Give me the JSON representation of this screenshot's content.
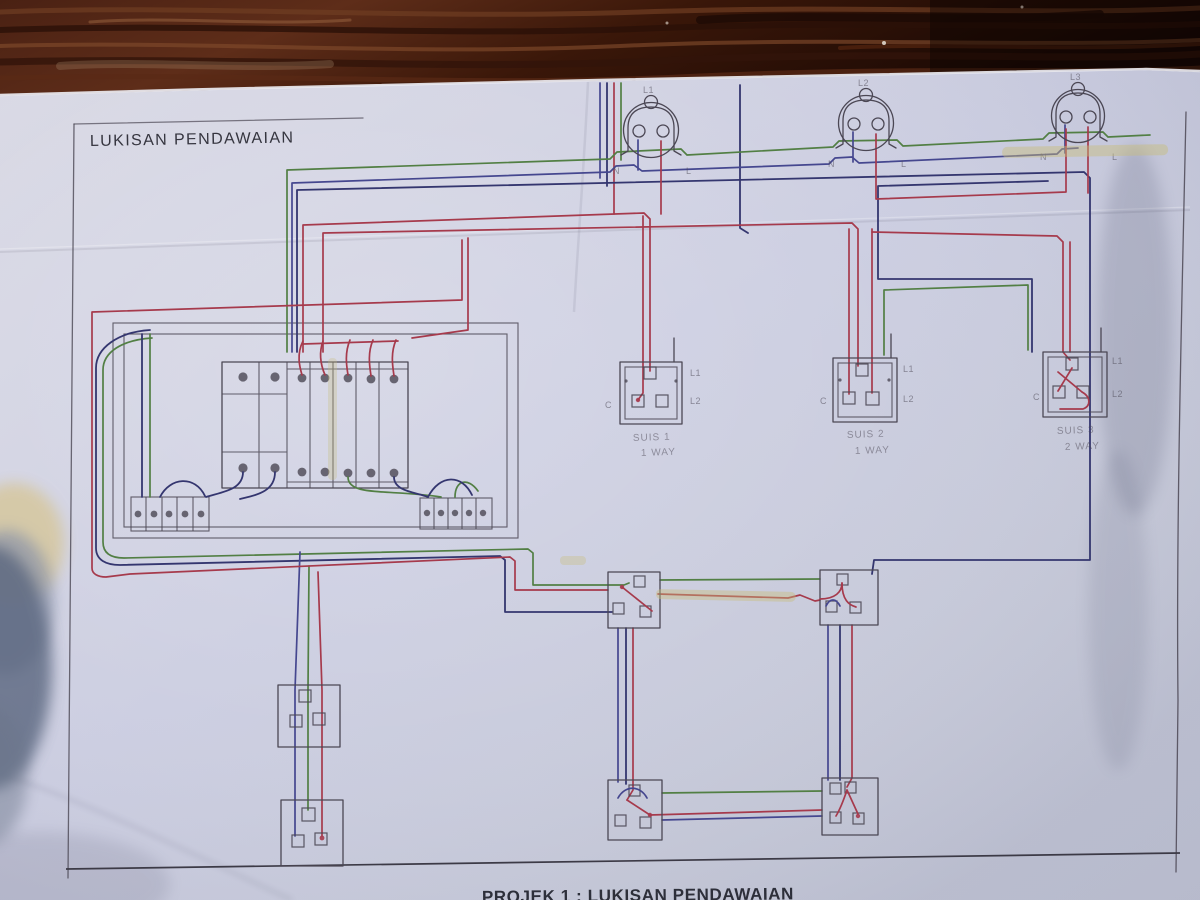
{
  "title": "LUKISAN PENDAWAIAN",
  "footer": "PROJEK 1 : LUKISAN PENDAWAIAN",
  "lamps": {
    "l1": "L1",
    "l2": "L2",
    "l3": "L3",
    "neutral_mark": "N",
    "live_mark": "L"
  },
  "switches": {
    "s1": {
      "name": "SUIS 1",
      "type": "1 WAY",
      "t_live": "L1",
      "t_l2": "L2",
      "t_common": "C"
    },
    "s2": {
      "name": "SUIS 2",
      "type": "1 WAY",
      "t_live": "L1",
      "t_l2": "L2",
      "t_common": "C"
    },
    "s3": {
      "name": "SUIS 3",
      "type": "2 WAY",
      "t_live": "L1",
      "t_l2": "L2",
      "t_common": "C"
    }
  },
  "colors": {
    "wood": "#33140b",
    "paper": "#cbcdda",
    "pencil": "#4b4754",
    "wire_red": "#a63a4c",
    "wire_green": "#527f44",
    "wire_blue": "#45478f",
    "wire_navy": "#34366f",
    "highlight": "#c8bd7a"
  }
}
